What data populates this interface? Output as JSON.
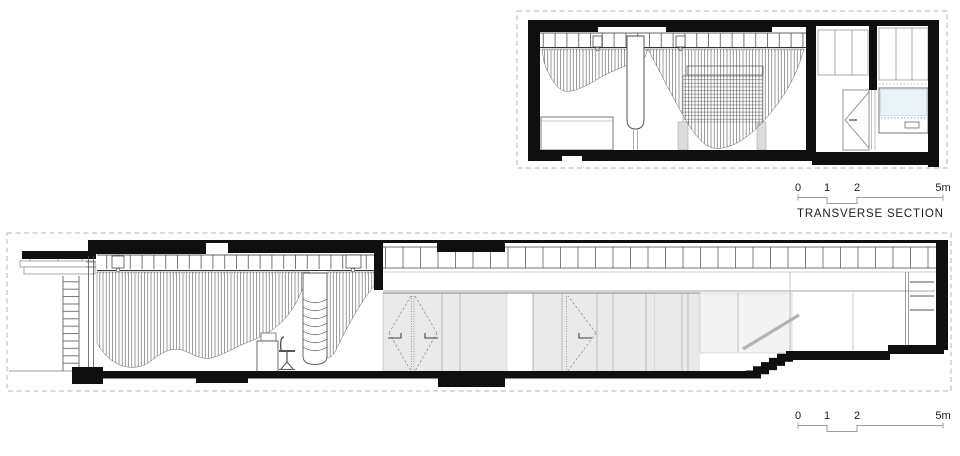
{
  "canvas": {
    "width": 960,
    "height": 456,
    "background": "#ffffff"
  },
  "transverse": {
    "title": "TRANSVERSE SECTION",
    "scale_labels": [
      "0",
      "1",
      "2",
      "5m"
    ]
  },
  "longitudinal": {
    "scale_labels": [
      "0",
      "1",
      "2",
      "5m"
    ]
  },
  "colors": {
    "line": "#0f0f0f",
    "panel_gray": "#e9e9e9",
    "panel_light": "#f3f3f3",
    "blue_tint": "#e9f2f6",
    "handrail_gray": "#b3b3b3",
    "dashed_border": "#b6b6b6",
    "hatch": "#4a4a4a",
    "text": "#1c1c1c"
  }
}
